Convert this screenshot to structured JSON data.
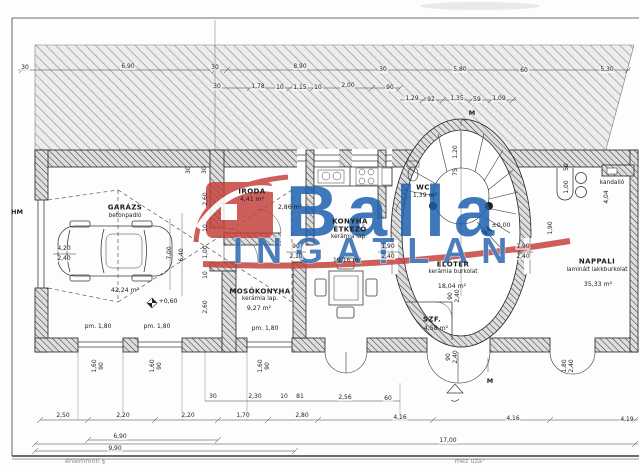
{
  "logo": {
    "word1": "Balla",
    "word2": "INGATLAN",
    "blue": "#1a5fae",
    "red": "#c5423c"
  },
  "plan": {
    "rooms": [
      {
        "name": "GARÁZS",
        "floor": "betonpadló",
        "area": "42,24 m²"
      },
      {
        "name": "IRODA",
        "area": "4,41 m²"
      },
      {
        "name": "",
        "area": "2,86 m²"
      },
      {
        "name": "MOSÓKONYHA",
        "floor": "kerámia lap.",
        "area": "9,27 m²"
      },
      {
        "name": "KONYHA ÉTKEZŐ",
        "floor": "kerámia lap.",
        "area": "19,16 m²"
      },
      {
        "name": "WC",
        "area": "1,39 m²"
      },
      {
        "name": "ELŐTÉR",
        "floor": "kerámia burkolat",
        "area": "18,04 m²"
      },
      {
        "name": "SZF.",
        "area": "4,58 m²"
      },
      {
        "name": "NAPPALI",
        "floor": "laminált lakkburkolat",
        "area": "35,33 m²"
      },
      {
        "name": "kandalló"
      }
    ],
    "labels": [
      {
        "t": "30",
        "x": 25,
        "y": 68
      },
      {
        "t": "6,90",
        "x": 128,
        "y": 67
      },
      {
        "t": "30",
        "x": 215,
        "y": 68
      },
      {
        "t": "8,90",
        "x": 300,
        "y": 67
      },
      {
        "t": "30",
        "x": 383,
        "y": 70
      },
      {
        "t": "5,80",
        "x": 460,
        "y": 70
      },
      {
        "t": "60",
        "x": 524,
        "y": 71
      },
      {
        "t": "5,30",
        "x": 607,
        "y": 70
      },
      {
        "t": "30",
        "x": 217,
        "y": 87
      },
      {
        "t": "1,78",
        "x": 258,
        "y": 87
      },
      {
        "t": "10",
        "x": 280,
        "y": 88
      },
      {
        "t": "1,15",
        "x": 300,
        "y": 88
      },
      {
        "t": "10",
        "x": 318,
        "y": 88
      },
      {
        "t": "2,00",
        "x": 348,
        "y": 86
      },
      {
        "t": "90",
        "x": 390,
        "y": 88
      },
      {
        "t": "1,29",
        "x": 412,
        "y": 99
      },
      {
        "t": "92",
        "x": 431,
        "y": 100
      },
      {
        "t": "1,35",
        "x": 457,
        "y": 99
      },
      {
        "t": "59",
        "x": 477,
        "y": 100
      },
      {
        "t": "1,09",
        "x": 499,
        "y": 99
      },
      {
        "t": "M",
        "x": 472,
        "y": 113,
        "k": "note"
      },
      {
        "t": "HM",
        "x": 17,
        "y": 212,
        "k": "note"
      },
      {
        "t": "4,20",
        "x": 64,
        "y": 249
      },
      {
        "t": "2,40",
        "x": 64,
        "y": 259
      },
      {
        "t": "GARÁZS",
        "x": 125,
        "y": 208,
        "k": "room"
      },
      {
        "t": "betonpadló",
        "x": 125,
        "y": 217,
        "k": "sub"
      },
      {
        "t": "42,24 m²",
        "x": 125,
        "y": 291,
        "k": "area"
      },
      {
        "t": "+0,60",
        "x": 168,
        "y": 302,
        "k": "area"
      },
      {
        "t": "pm. 1,80",
        "x": 98,
        "y": 327
      },
      {
        "t": "pm. 1,80",
        "x": 157,
        "y": 327
      },
      {
        "t": "7,00",
        "x": 170,
        "y": 253,
        "r": 1
      },
      {
        "t": "6,40",
        "x": 182,
        "y": 255,
        "r": 1
      },
      {
        "t": "30",
        "x": 189,
        "y": 170,
        "r": 1
      },
      {
        "t": "30",
        "x": 205,
        "y": 170,
        "r": 1
      },
      {
        "t": "2,60",
        "x": 206,
        "y": 199,
        "r": 1
      },
      {
        "t": "10",
        "x": 206,
        "y": 228,
        "r": 1
      },
      {
        "t": "1,00",
        "x": 206,
        "y": 252,
        "r": 1
      },
      {
        "t": "10",
        "x": 206,
        "y": 275,
        "r": 1
      },
      {
        "t": "2,60",
        "x": 206,
        "y": 307,
        "r": 1
      },
      {
        "t": "IRODA",
        "x": 252,
        "y": 192,
        "k": "room"
      },
      {
        "t": "4,41 m²",
        "x": 252,
        "y": 200,
        "k": "area"
      },
      {
        "t": "2,86 m²",
        "x": 290,
        "y": 208,
        "k": "area"
      },
      {
        "t": "KONYHA",
        "x": 350,
        "y": 222,
        "k": "room"
      },
      {
        "t": "ÉTKEZŐ",
        "x": 350,
        "y": 230,
        "k": "room"
      },
      {
        "t": "kerámia lap.",
        "x": 349,
        "y": 238,
        "k": "sub"
      },
      {
        "t": "19,16 m²",
        "x": 347,
        "y": 261,
        "k": "area"
      },
      {
        "t": "MOSÓKONYHA",
        "x": 260,
        "y": 292,
        "k": "room"
      },
      {
        "t": "kerámia lap.",
        "x": 260,
        "y": 300,
        "k": "sub"
      },
      {
        "t": "9,27 m²",
        "x": 259,
        "y": 309,
        "k": "area"
      },
      {
        "t": "pm. 1,80",
        "x": 265,
        "y": 329
      },
      {
        "t": "90",
        "x": 296,
        "y": 247
      },
      {
        "t": "2,10",
        "x": 296,
        "y": 257
      },
      {
        "t": "1,90",
        "x": 388,
        "y": 247
      },
      {
        "t": "2,40",
        "x": 388,
        "y": 257
      },
      {
        "t": "1,90",
        "x": 523,
        "y": 247
      },
      {
        "t": "2,40",
        "x": 523,
        "y": 257
      },
      {
        "t": "WC",
        "x": 423,
        "y": 188,
        "k": "room"
      },
      {
        "t": "1,39 m²",
        "x": 425,
        "y": 196,
        "k": "area"
      },
      {
        "t": "1,20",
        "x": 456,
        "y": 152,
        "r": 1
      },
      {
        "t": "75",
        "x": 456,
        "y": 172,
        "r": 1
      },
      {
        "t": "±0,00",
        "x": 501,
        "y": 226,
        "k": "area"
      },
      {
        "t": "ELŐTÉR",
        "x": 453,
        "y": 265,
        "k": "room"
      },
      {
        "t": "kerámia burkolat",
        "x": 453,
        "y": 273,
        "k": "sub"
      },
      {
        "t": "18,04 m²",
        "x": 452,
        "y": 287,
        "k": "area"
      },
      {
        "t": "SZF.",
        "x": 432,
        "y": 320,
        "k": "room"
      },
      {
        "t": "4,58 m²",
        "x": 436,
        "y": 329,
        "k": "area"
      },
      {
        "t": "90",
        "x": 451,
        "y": 296,
        "r": 1
      },
      {
        "t": "2,40",
        "x": 458,
        "y": 296,
        "r": 1
      },
      {
        "t": "kandalló",
        "x": 612,
        "y": 184,
        "k": "sub"
      },
      {
        "t": "NAPPALI",
        "x": 597,
        "y": 262,
        "k": "room"
      },
      {
        "t": "laminált lakkburkolat",
        "x": 597,
        "y": 271,
        "k": "sub"
      },
      {
        "t": "35,33 m²",
        "x": 598,
        "y": 285,
        "k": "area"
      },
      {
        "t": "50",
        "x": 567,
        "y": 167,
        "r": 1
      },
      {
        "t": "1,00",
        "x": 567,
        "y": 187,
        "r": 1
      },
      {
        "t": "1,90",
        "x": 551,
        "y": 228,
        "r": 1
      },
      {
        "t": "4,04",
        "x": 607,
        "y": 197,
        "r": 1
      },
      {
        "t": "1,60",
        "x": 95,
        "y": 366,
        "r": 1
      },
      {
        "t": "90",
        "x": 102,
        "y": 366,
        "r": 1
      },
      {
        "t": "1,60",
        "x": 153,
        "y": 366,
        "r": 1
      },
      {
        "t": "90",
        "x": 160,
        "y": 366,
        "r": 1
      },
      {
        "t": "1,60",
        "x": 261,
        "y": 366,
        "r": 1
      },
      {
        "t": "90",
        "x": 268,
        "y": 366,
        "r": 1
      },
      {
        "t": "90",
        "x": 449,
        "y": 357,
        "r": 1
      },
      {
        "t": "2,40",
        "x": 456,
        "y": 357,
        "r": 1
      },
      {
        "t": "1,80",
        "x": 565,
        "y": 366,
        "r": 1
      },
      {
        "t": "2,40",
        "x": 572,
        "y": 366,
        "r": 1
      },
      {
        "t": "M",
        "x": 490,
        "y": 381,
        "k": "note"
      },
      {
        "t": "30",
        "x": 213,
        "y": 397
      },
      {
        "t": "2,30",
        "x": 255,
        "y": 397
      },
      {
        "t": "10",
        "x": 284,
        "y": 397
      },
      {
        "t": "81",
        "x": 300,
        "y": 397
      },
      {
        "t": "2,56",
        "x": 345,
        "y": 398
      },
      {
        "t": "60",
        "x": 388,
        "y": 399
      },
      {
        "t": "2,50",
        "x": 63,
        "y": 416
      },
      {
        "t": "2,20",
        "x": 123,
        "y": 416
      },
      {
        "t": "2,20",
        "x": 188,
        "y": 416
      },
      {
        "t": "1,70",
        "x": 243,
        "y": 416
      },
      {
        "t": "2,80",
        "x": 302,
        "y": 416
      },
      {
        "t": "4,16",
        "x": 400,
        "y": 418
      },
      {
        "t": "4,16",
        "x": 513,
        "y": 419
      },
      {
        "t": "4,19",
        "x": 627,
        "y": 420
      },
      {
        "t": "6,90",
        "x": 120,
        "y": 437
      },
      {
        "t": "17,00",
        "x": 448,
        "y": 441
      },
      {
        "t": "9,90",
        "x": 115,
        "y": 449
      },
      {
        "t": "énlemmon §",
        "x": 85,
        "y": 461,
        "k": "footer"
      },
      {
        "t": "mez uza°",
        "x": 470,
        "y": 461,
        "k": "footer"
      }
    ]
  }
}
